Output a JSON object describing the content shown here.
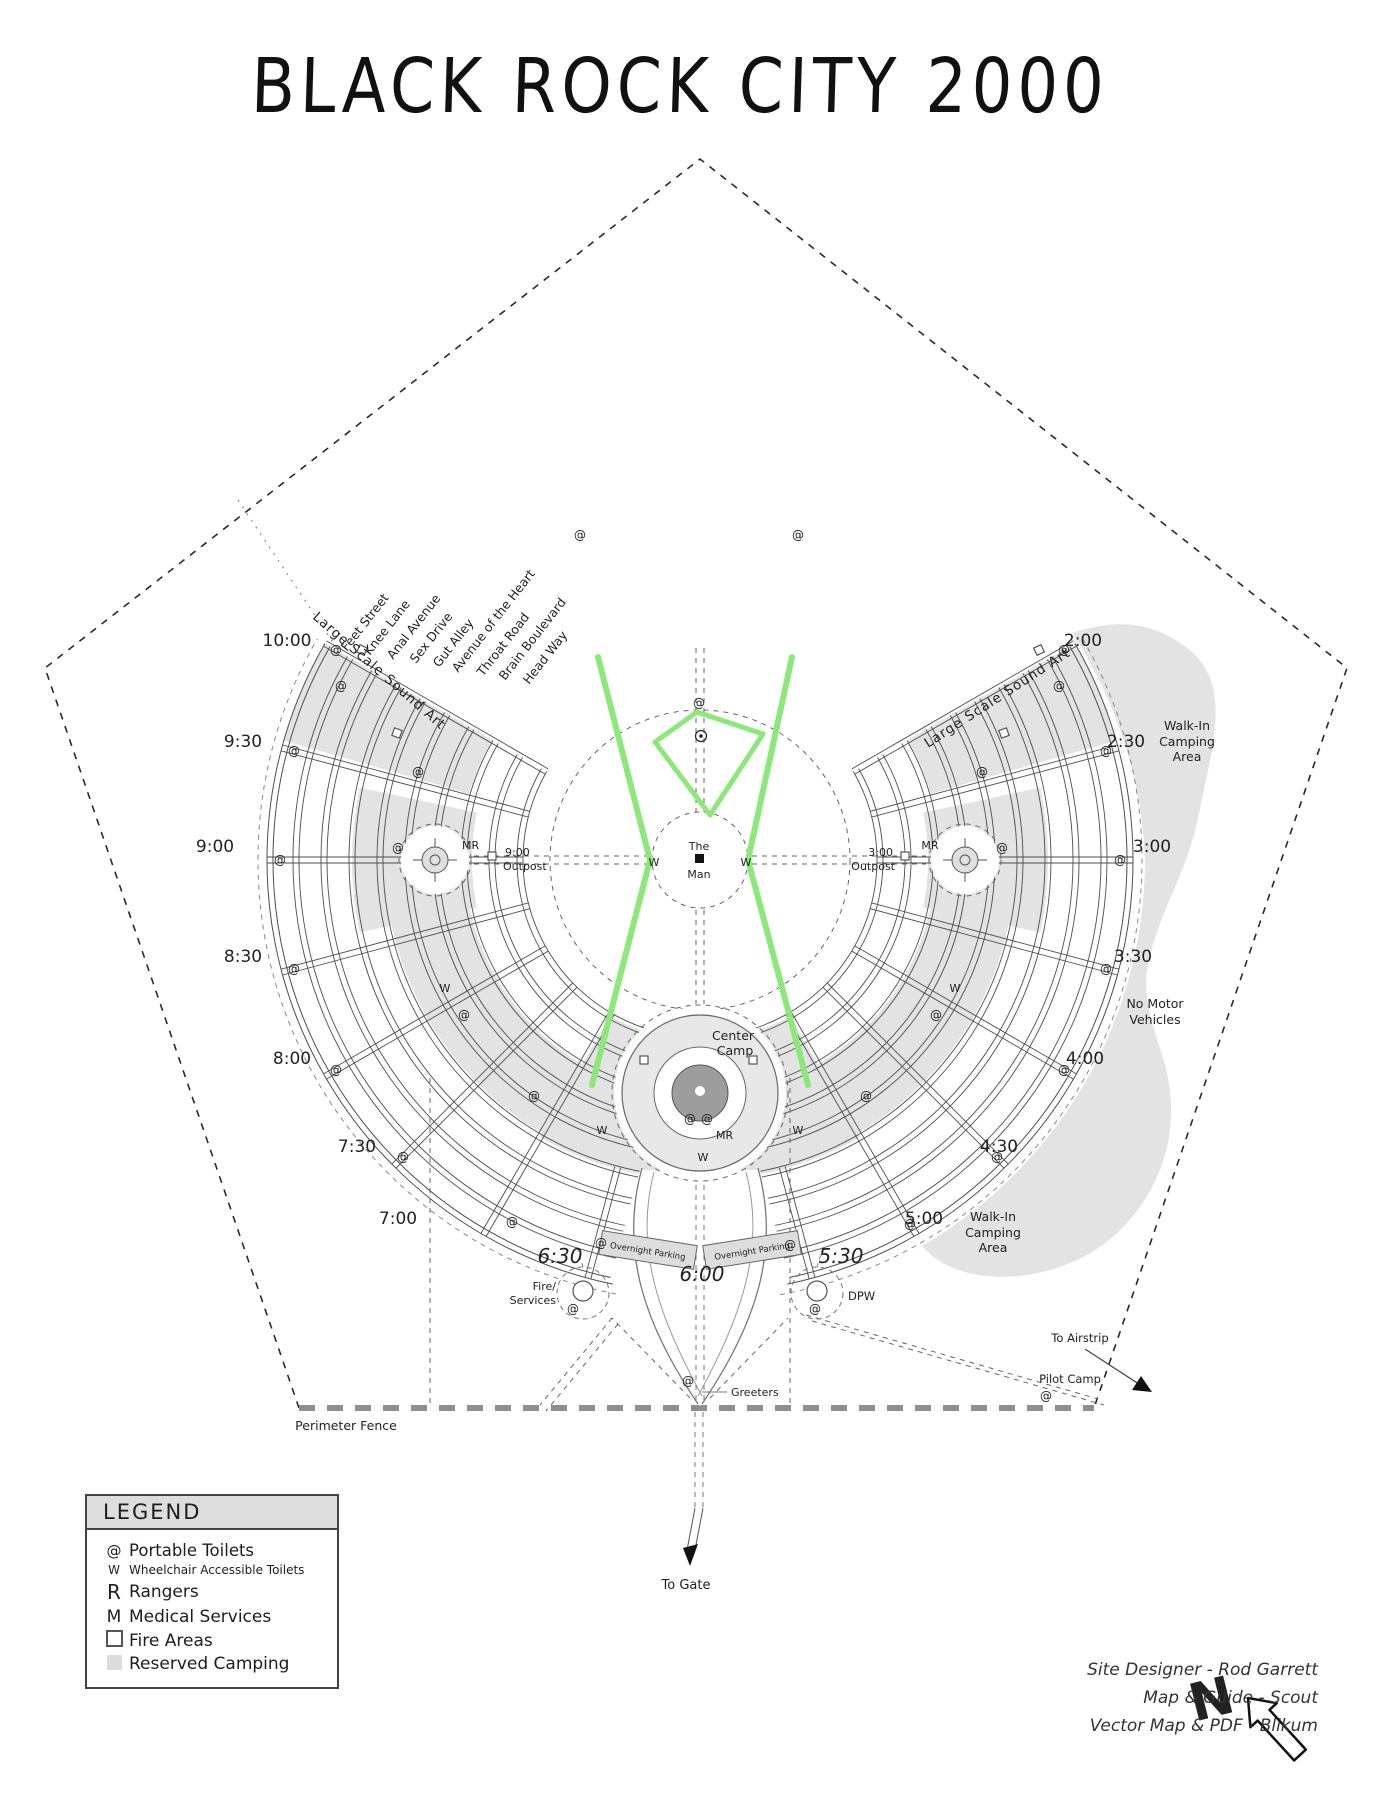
{
  "title": "BLACK ROCK CITY 2000",
  "streets": [
    "Feet Street",
    "Knee Lane",
    "Anal Avenue",
    "Sex Drive",
    "Gut Alley",
    "Avenue of the Heart",
    "Throat Road",
    "Brain Boulevard",
    "Head Way"
  ],
  "clock": [
    "10:00",
    "9:30",
    "9:00",
    "8:30",
    "8:00",
    "7:30",
    "7:00",
    "6:30",
    "6:00",
    "5:30",
    "5:00",
    "4:30",
    "4:00",
    "3:30",
    "3:00",
    "2:30",
    "2:00"
  ],
  "labels": {
    "the": "The",
    "man": "Man",
    "center": "Center",
    "camp": "Camp",
    "mr": "MR",
    "w": "W",
    "toilet": "@",
    "sound_art": "Large Scale Sound Art",
    "outpost_left_time": "9:00",
    "outpost_right_time": "3:00",
    "outpost": "Outpost",
    "walkin_1": "Walk-In",
    "walkin_2": "Camping",
    "walkin_3": "Area",
    "no_motor_1": "No Motor",
    "no_motor_2": "Vehicles",
    "overnight": "Overnight Parking",
    "fire_1": "Fire/",
    "fire_2": "Services",
    "dpw": "DPW",
    "greeters": "Greeters",
    "to_gate": "To Gate",
    "to_airstrip": "To Airstrip",
    "pilot_camp": "Pilot Camp",
    "perimeter": "Perimeter Fence",
    "north": "N"
  },
  "legend": {
    "title": "LEGEND",
    "items": [
      {
        "symbol": "@",
        "label": "Portable Toilets"
      },
      {
        "symbol": "W",
        "label": "Wheelchair Accessible Toilets"
      },
      {
        "symbol": "R",
        "label": "Rangers"
      },
      {
        "symbol": "M",
        "label": "Medical Services"
      },
      {
        "symbol": "",
        "label": "Fire Areas"
      },
      {
        "symbol": "",
        "label": "Reserved Camping"
      }
    ]
  },
  "credits": {
    "line1": "Site Designer - Rod Garrett",
    "line2": "Map & Guide - Scout",
    "line3": "Vector Map & PDF - Blikum"
  },
  "colors": {
    "green": "#8CE878",
    "reserved": "#e3e3e3",
    "ink": "#222222"
  }
}
